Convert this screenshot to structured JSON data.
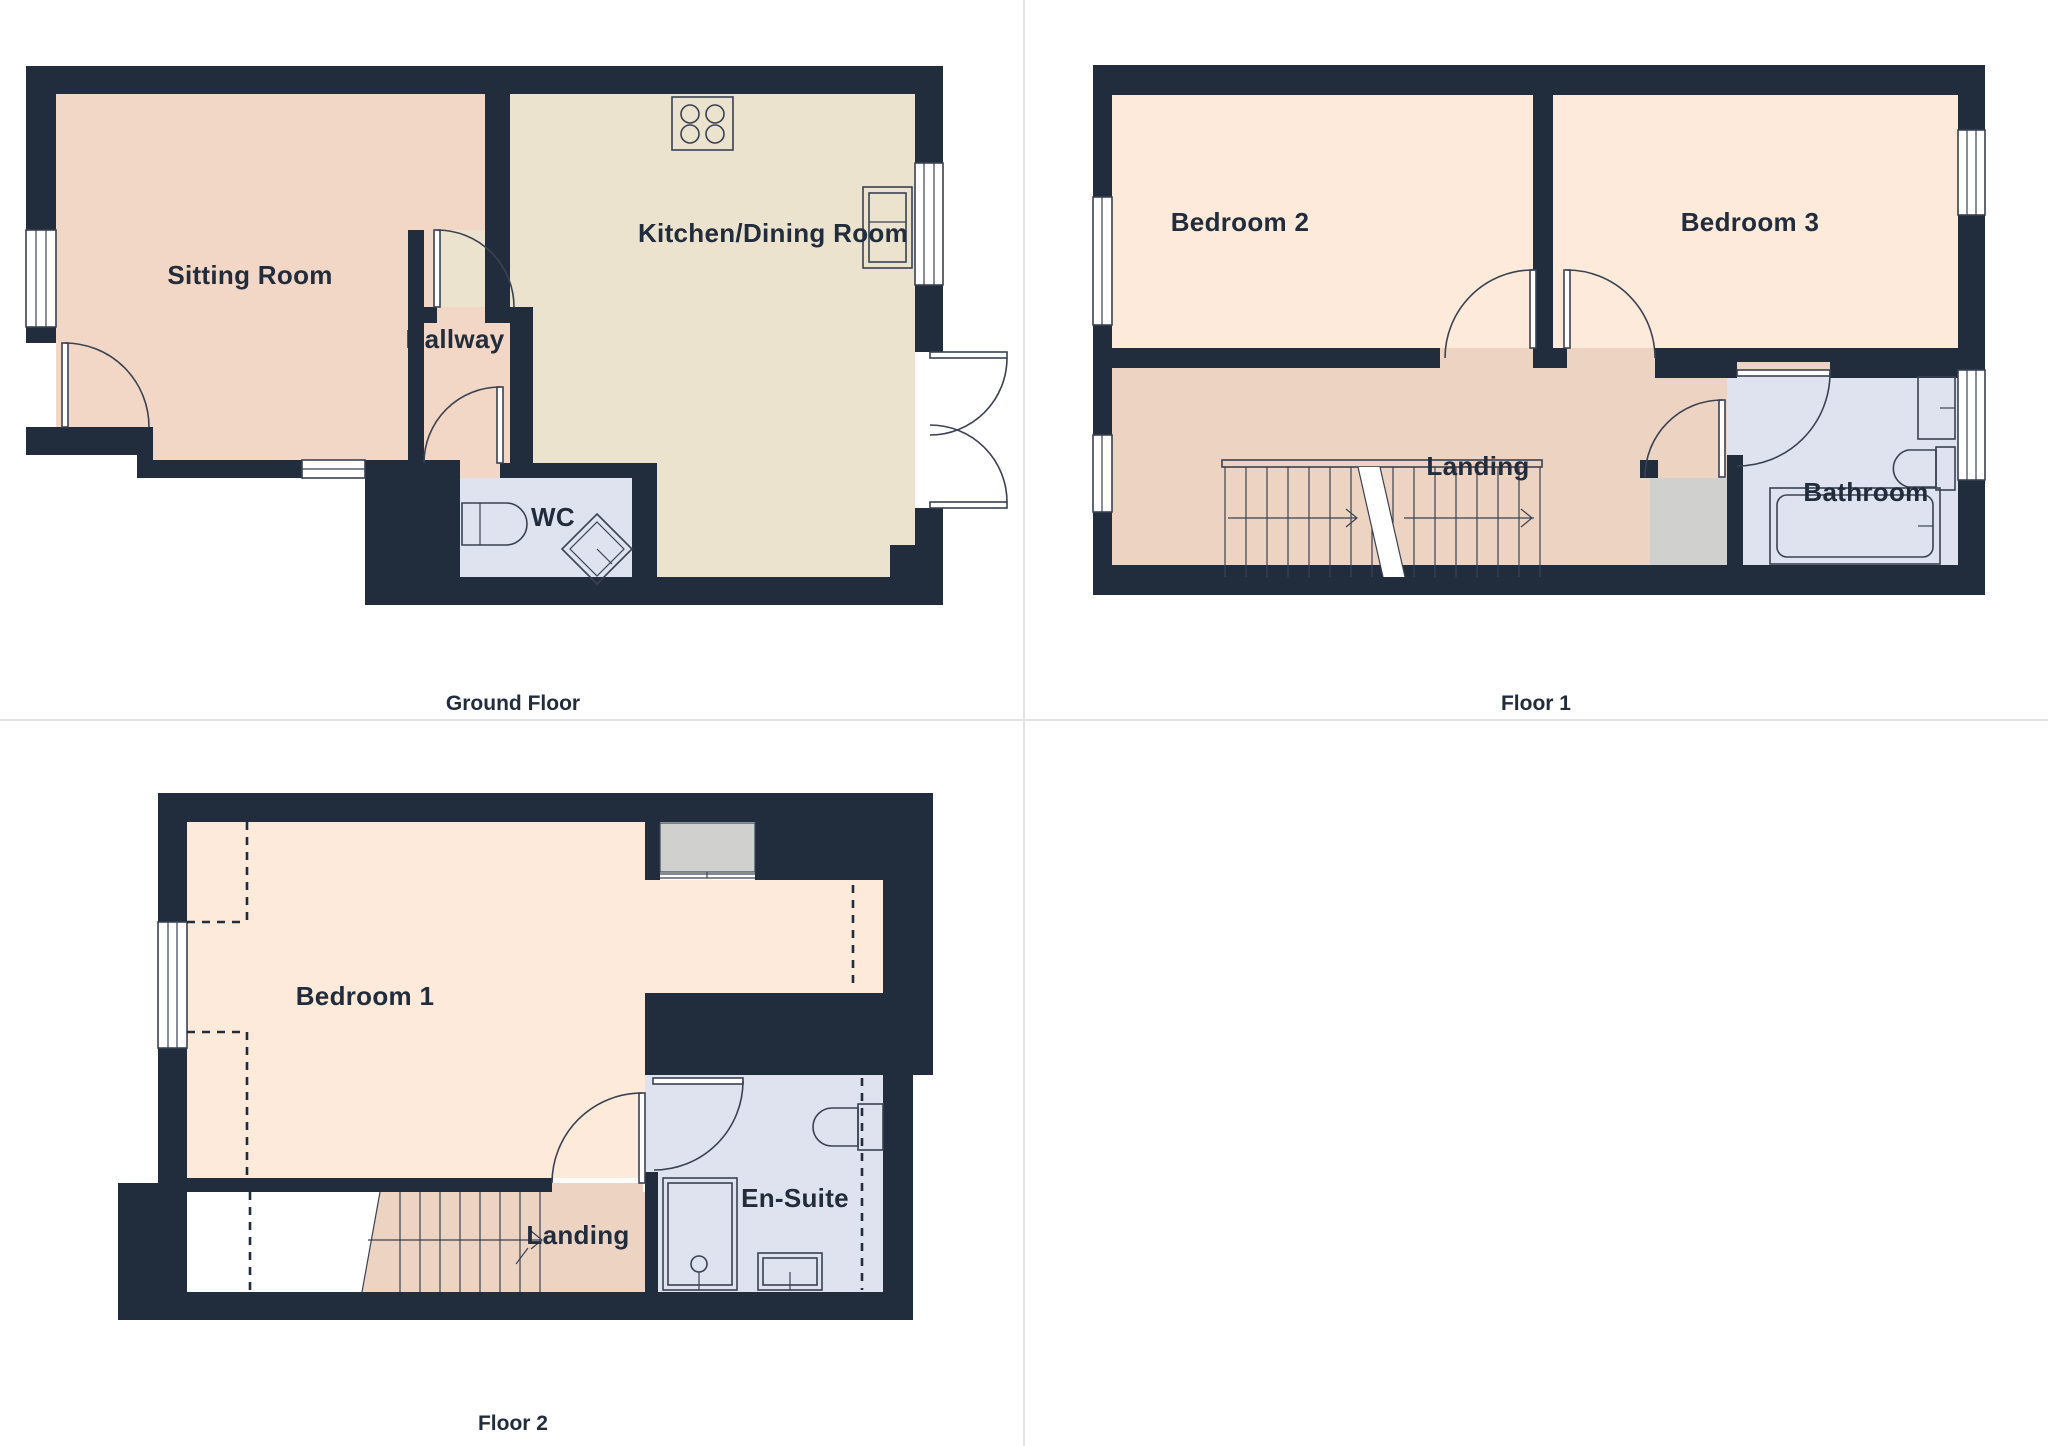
{
  "title": "Property floor plans",
  "palette": {
    "wall": "#212c3c",
    "sitting_pink": "#f3d7c6",
    "landing_pink": "#edd3c2",
    "bedroom_peach": "#fdeada",
    "kitchen_cream": "#ebe3cd",
    "bath_blue": "#dee3ef",
    "cupboard_grey": "#d0d1cf",
    "fixture_line": "#3a4252",
    "label_color": "#212c3c",
    "divider": "#e4e4e4",
    "background": "#ffffff"
  },
  "floors": [
    {
      "caption": "Ground Floor",
      "rooms": [
        {
          "label": "Sitting Room"
        },
        {
          "label": "Hallway"
        },
        {
          "label": "WC"
        },
        {
          "label": "Kitchen/Dining Room"
        }
      ],
      "fixtures": [
        "hob",
        "kitchen-sink",
        "toilet",
        "corner-basin",
        "french-doors",
        "windows",
        "doors"
      ]
    },
    {
      "caption": "Floor 1",
      "rooms": [
        {
          "label": "Bedroom 2"
        },
        {
          "label": "Bedroom 3"
        },
        {
          "label": "Landing"
        },
        {
          "label": "Bathroom"
        }
      ],
      "fixtures": [
        "stairs-up",
        "bathtub",
        "toilet",
        "basin",
        "cupboard",
        "windows",
        "doors"
      ]
    },
    {
      "caption": "Floor 2",
      "rooms": [
        {
          "label": "Bedroom 1"
        },
        {
          "label": "Landing"
        },
        {
          "label": "En-Suite"
        }
      ],
      "fixtures": [
        "stairs-down",
        "shower",
        "toilet",
        "basin",
        "storage",
        "window",
        "head-height-lines",
        "doors"
      ]
    }
  ]
}
